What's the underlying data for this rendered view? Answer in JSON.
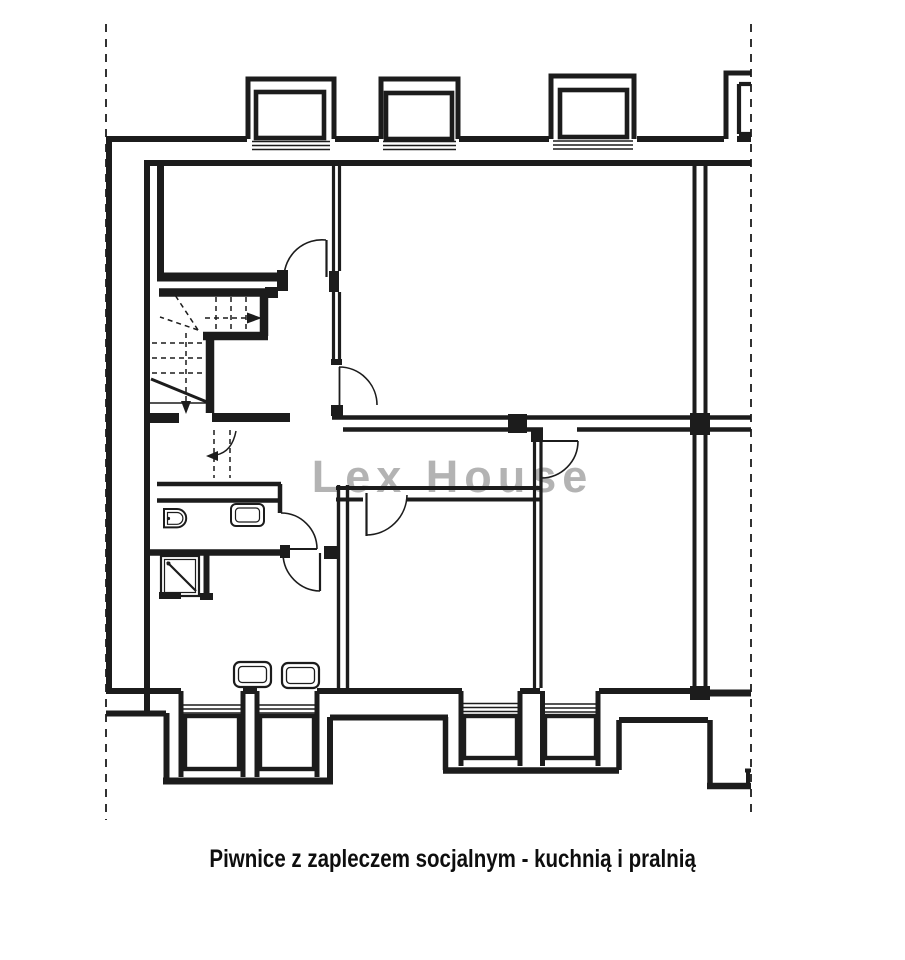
{
  "page": {
    "background": "#ffffff"
  },
  "watermark": {
    "text": "Lex House",
    "color": "#b3b3b3"
  },
  "caption": {
    "text": "Piwnice z zapleczem socjalnym - kuchnią i pralnią",
    "color": "#0e0e0e"
  },
  "drawing": {
    "line_color": "#1c1c1c",
    "type": "basement floor plan (scanned architectural drawing)",
    "symbols": [
      "section-boundary-dashed-line",
      "exterior-wall",
      "interior-wall",
      "window-bay",
      "door-swing",
      "staircase-with-winders",
      "walk-line-arrow",
      "shower-tray",
      "washbasin",
      "cistern",
      "kitchen-appliance",
      "wall-pier"
    ]
  }
}
